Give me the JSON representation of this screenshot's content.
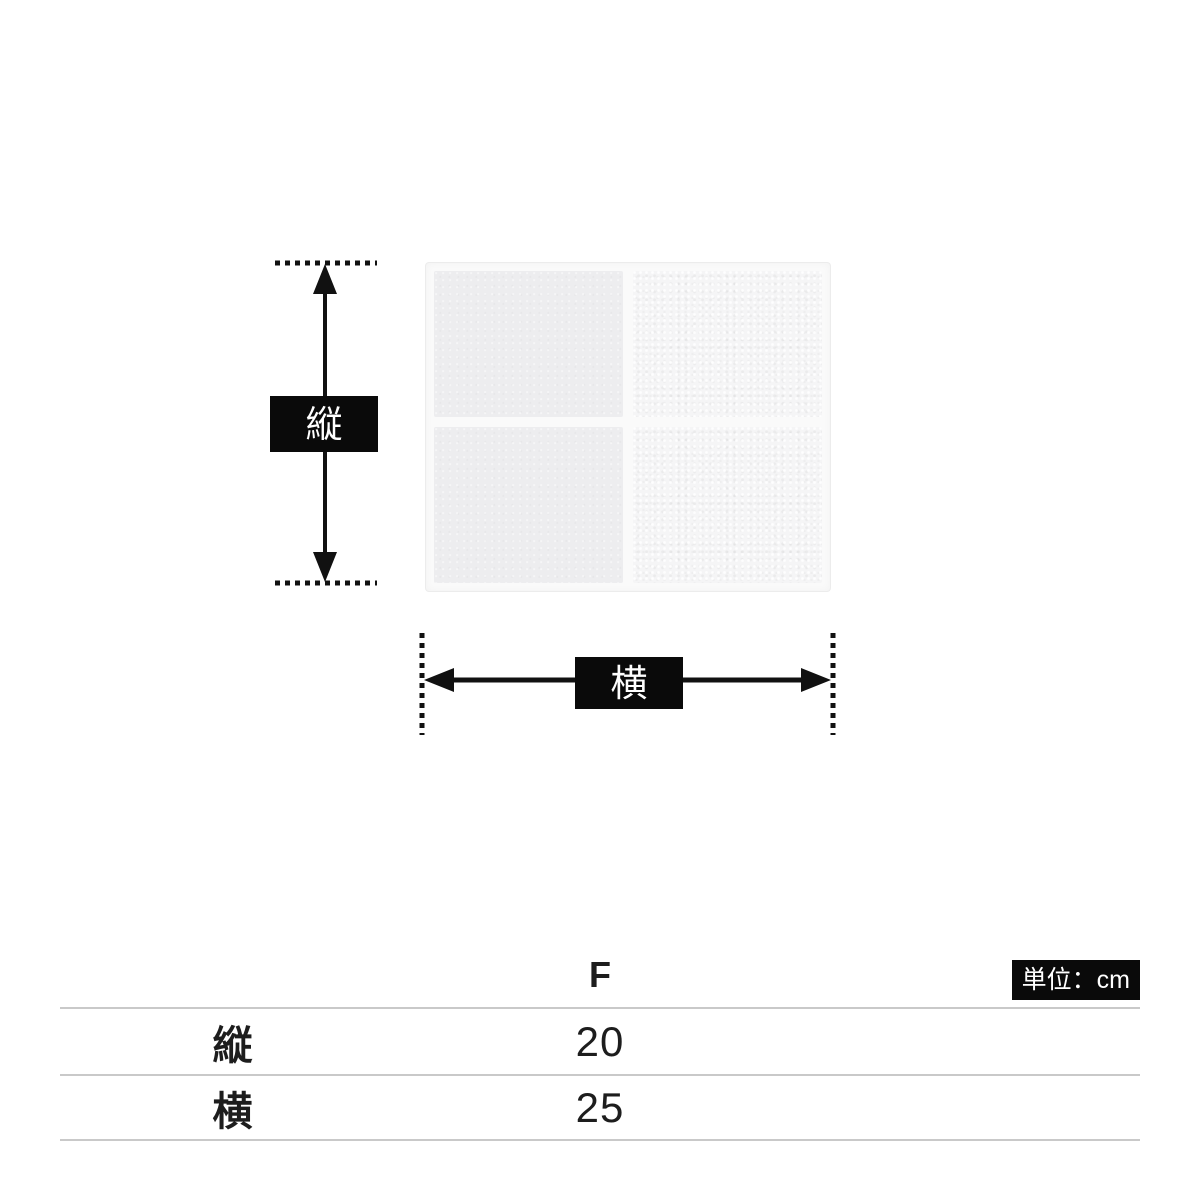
{
  "theme": {
    "background": "#ffffff",
    "arrow_color": "#111111",
    "label_bg": "#0a0a0a",
    "label_text": "#ffffff",
    "table_line": "#c9c9c9",
    "text_color": "#1d1d1d",
    "badge_bg": "#0a0a0a",
    "badge_text": "#ffffff",
    "towel_smooth": "#ededef",
    "towel_terry": "#f5f5f6",
    "towel_edge": "#fafafa"
  },
  "diagram": {
    "product": "four-panel hand towel photo",
    "vertical_label": "縦",
    "horizontal_label": "横"
  },
  "size_table": {
    "unit_badge": "単位：cm",
    "column_header": "F",
    "rows": [
      {
        "label": "縦",
        "value": "20"
      },
      {
        "label": "横",
        "value": "25"
      }
    ]
  }
}
